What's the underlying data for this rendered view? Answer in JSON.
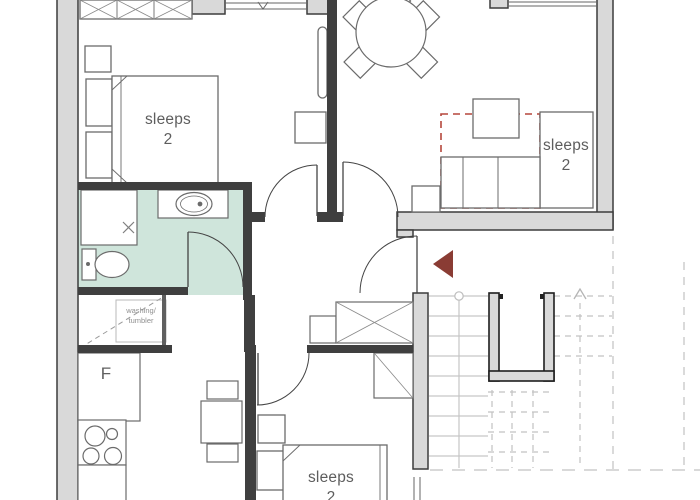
{
  "plan": {
    "rooms": [
      {
        "id": "bedroom-top-left",
        "label": "sleeps",
        "capacity": "2"
      },
      {
        "id": "lounge-sofa-bed",
        "label": "sleeps",
        "capacity": "2"
      },
      {
        "id": "bedroom-bottom",
        "label": "sleeps",
        "capacity": "2"
      }
    ],
    "utility_closet": {
      "line1": "washing/",
      "line2": "tumbler"
    },
    "kitchen": {
      "fridge_label": "F"
    },
    "icons": [
      "double-bed-icon",
      "wardrobe-icon",
      "dining-table-icon",
      "sofa-bed-icon",
      "coffee-table-icon",
      "toilet-icon",
      "washbasin-icon",
      "shower-icon",
      "hob-icon",
      "radiator-icon",
      "staircase-icon",
      "entrance-arrow-icon",
      "door-swing-icon",
      "window-icon"
    ],
    "colors": {
      "bathroom_floor": "#cfe5db",
      "exterior_wall": "#d9d9d9",
      "partition_wall": "#3f3f3f",
      "sofa_bed_outline_dashed": "#b5473c",
      "entrance_marker": "#8a3c34",
      "stair_tread": "#c6c6c6"
    }
  }
}
